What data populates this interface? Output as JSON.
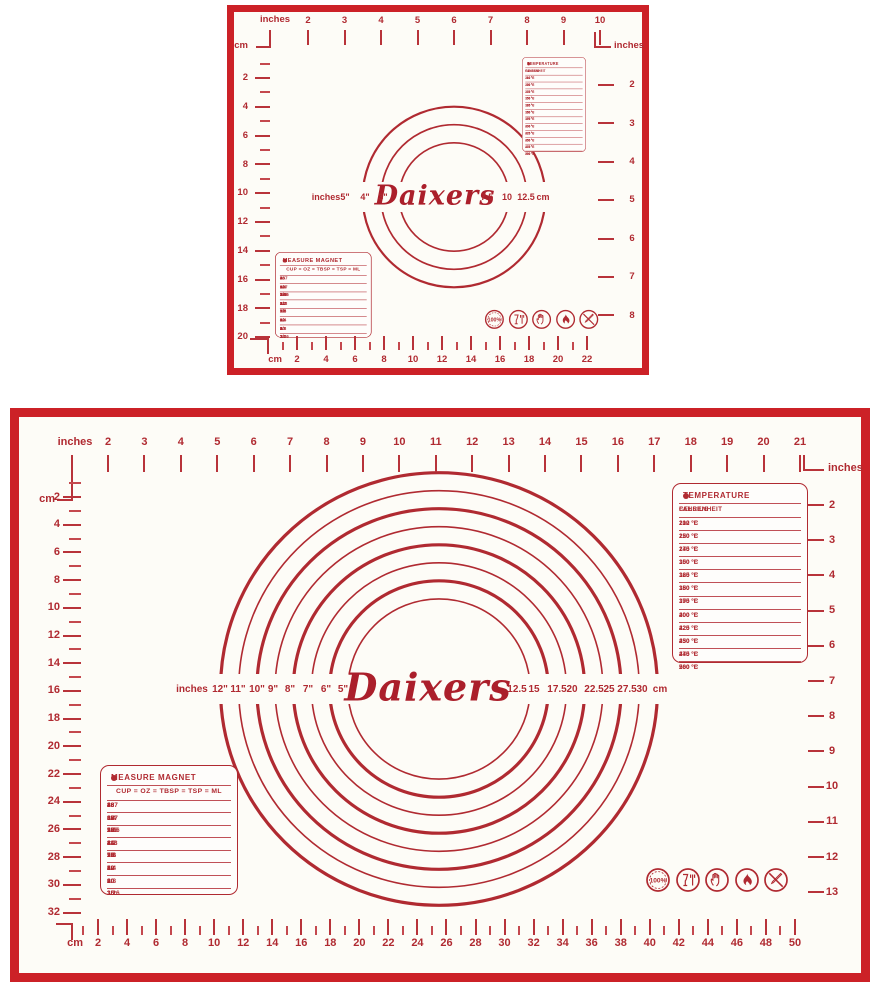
{
  "product": {
    "brand_script": "Daixers"
  },
  "colors": {
    "frame_red": "#cc2127",
    "ink": "#b02a31",
    "mat_bg": "#fdfcf7"
  },
  "temperature_table": {
    "title": "TEMPERATURE",
    "columns": [
      "FAHRENHEIT",
      "CELSIUS"
    ],
    "rows": [
      [
        "212 °F",
        "100 °C"
      ],
      [
        "250 °F",
        "120 °C"
      ],
      [
        "275 °F",
        "140 °C"
      ],
      [
        "300 °F",
        "150 °C"
      ],
      [
        "325 °F",
        "160 °C"
      ],
      [
        "350 °F",
        "180 °C"
      ],
      [
        "375 °F",
        "190 °C"
      ],
      [
        "400 °F",
        "200 °C"
      ],
      [
        "425 °F",
        "220 °C"
      ],
      [
        "450 °F",
        "230 °C"
      ],
      [
        "475 °F",
        "240 °C"
      ],
      [
        "500 °F",
        "260 °C"
      ]
    ]
  },
  "measure_table": {
    "title": "MEASURE MAGNET",
    "columns": [
      "CUP",
      "OZ",
      "TBSP",
      "TSP",
      "ML"
    ],
    "columns_separator": " = ",
    "rows": [
      [
        "1",
        "8",
        "16",
        "48",
        "237"
      ],
      [
        "3/4",
        "6",
        "12",
        "36",
        "177"
      ],
      [
        "2/3",
        "5⅓",
        "10.6",
        "32",
        "158"
      ],
      [
        "1/2",
        "4",
        "8",
        "24",
        "118"
      ],
      [
        "1/3",
        "2⅔",
        "5.3",
        "16",
        "79"
      ],
      [
        "1/4",
        "2",
        "4",
        "12",
        "59"
      ],
      [
        "1/8",
        "1",
        "2",
        "6",
        "30"
      ],
      [
        "1/16",
        "1/2",
        "1",
        "3",
        "15"
      ]
    ]
  },
  "icons": {
    "badge_label": "100%",
    "names": [
      "quality-100-percent-icon",
      "food-safe-glass-fork-icon",
      "hand-safe-icon",
      "flame-resistant-icon",
      "no-sharp-utensils-icon"
    ]
  },
  "small_mat": {
    "top_ruler": {
      "unit_label": "inches",
      "cm_label": "cm",
      "right_unit_label": "inches",
      "numbers": [
        "2",
        "3",
        "4",
        "5",
        "6",
        "7",
        "8",
        "9",
        "10"
      ]
    },
    "left_ruler": {
      "numbers": [
        "2",
        "4",
        "6",
        "8",
        "10",
        "12",
        "14",
        "16",
        "18",
        "20"
      ]
    },
    "right_ruler": {
      "numbers": [
        "2",
        "3",
        "4",
        "5",
        "6",
        "7",
        "8"
      ]
    },
    "bottom_ruler": {
      "unit_label": "cm",
      "numbers": [
        "2",
        "4",
        "6",
        "8",
        "10",
        "12",
        "14",
        "16",
        "18",
        "20",
        "22"
      ]
    },
    "rings": {
      "unit_left": "inches",
      "unit_right": "cm",
      "left_labels": [
        "5\"",
        "4\"",
        "3\""
      ],
      "right_labels": [
        "7.5",
        "10",
        "12.5"
      ],
      "diameters_inches": [
        5,
        4,
        3
      ]
    }
  },
  "large_mat": {
    "top_ruler": {
      "unit_label": "inches",
      "cm_label": "cm",
      "right_unit_label": "inches",
      "numbers": [
        "2",
        "3",
        "4",
        "5",
        "6",
        "7",
        "8",
        "9",
        "10",
        "11",
        "12",
        "13",
        "14",
        "15",
        "16",
        "17",
        "18",
        "19",
        "20",
        "21"
      ]
    },
    "left_ruler": {
      "numbers": [
        "2",
        "4",
        "6",
        "8",
        "10",
        "12",
        "14",
        "16",
        "18",
        "20",
        "22",
        "24",
        "26",
        "28",
        "30",
        "32"
      ]
    },
    "right_ruler": {
      "numbers": [
        "2",
        "3",
        "4",
        "5",
        "6",
        "7",
        "8",
        "9",
        "10",
        "11",
        "12",
        "13"
      ]
    },
    "bottom_ruler": {
      "unit_label": "cm",
      "numbers": [
        "2",
        "4",
        "6",
        "8",
        "10",
        "12",
        "14",
        "16",
        "18",
        "20",
        "22",
        "24",
        "26",
        "28",
        "30",
        "32",
        "34",
        "36",
        "38",
        "40",
        "42",
        "44",
        "46",
        "48",
        "50"
      ]
    },
    "rings": {
      "unit_left": "inches",
      "unit_right": "cm",
      "left_labels": [
        "12\"",
        "11\"",
        "10\"",
        "9\"",
        "8\"",
        "7\"",
        "6\"",
        "5\""
      ],
      "right_labels": [
        "12.5",
        "15",
        "17.5",
        "20",
        "22.5",
        "25",
        "27.5",
        "30"
      ],
      "diameters_inches": [
        12,
        11,
        10,
        9,
        8,
        7,
        6,
        5
      ]
    }
  }
}
